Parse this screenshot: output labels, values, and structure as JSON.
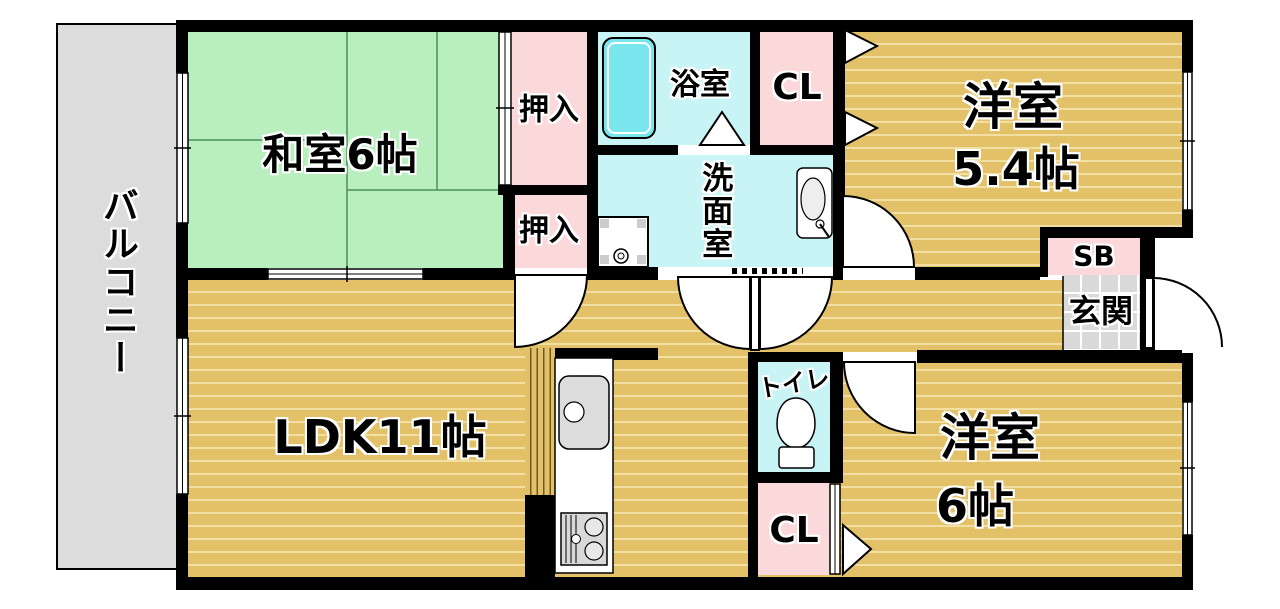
{
  "floorplan": {
    "balcony_label": "バルコニー",
    "rooms": {
      "washitsu": "和室6帖",
      "ldk": "LDK11帖",
      "yoshitsu54_line1": "洋室",
      "yoshitsu54_line2": "5.4帖",
      "yoshitsu6_line1": "洋室",
      "yoshitsu6_line2": "6帖",
      "bathroom": "浴室",
      "washroom": "洗面室",
      "toilet": "トイレ",
      "genkan": "玄関",
      "shoebox": "SB",
      "closet_top": "CL",
      "closet_bottom": "CL",
      "oshiire_top": "押入",
      "oshiire_bottom": "押入"
    },
    "colors": {
      "wood": "#e2c169",
      "wood_stripe": "#f2dfa3",
      "tatami": "#b9efbe",
      "pink": "#fbd9da",
      "cyan_room": "#c9f4f6",
      "bathtub": "#79e6ee",
      "balcony_gray": "#dcdcdc",
      "genkan_tile": "#d9d9d9",
      "wall": "#000000"
    }
  }
}
